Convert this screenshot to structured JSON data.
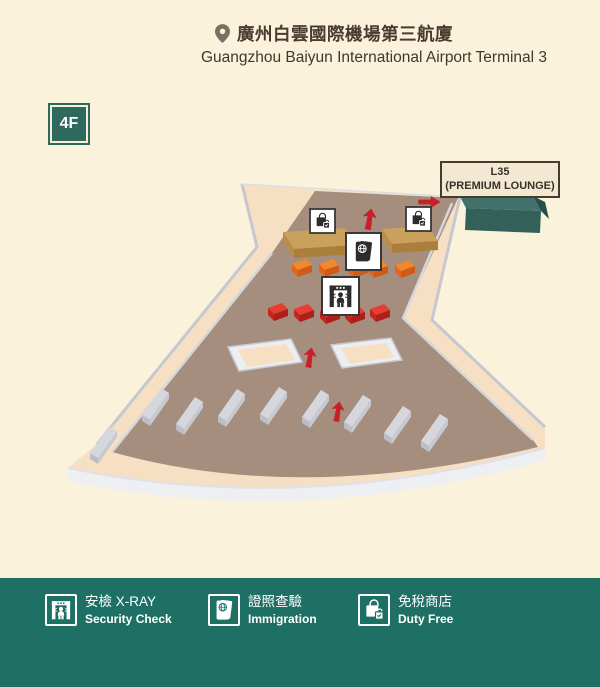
{
  "header": {
    "title_zh": "廣州白雲國際機場第三航廈",
    "title_en": "Guangzhou Baiyun International Airport Terminal 3"
  },
  "floor_badge": {
    "label": "4F"
  },
  "map": {
    "lounge_label": {
      "line1": "L35",
      "line2": "(PREMIUM LOUNGE)"
    },
    "markers": [
      {
        "name": "duty-free-shop",
        "icon": "duty-free-bag-icon"
      },
      {
        "name": "duty-free-shop",
        "icon": "duty-free-bag-icon"
      },
      {
        "name": "immigration",
        "icon": "passport-icon"
      },
      {
        "name": "security-check",
        "icon": "xray-gate-icon"
      }
    ],
    "flow_arrows": [
      "up",
      "up",
      "up",
      "right"
    ],
    "counters": {
      "immigration_counters": 5,
      "security_counters": 5,
      "checkin_counter_slabs": 9,
      "duty_free_counters": 2,
      "stair_wells": 2
    }
  },
  "legend": {
    "items": [
      {
        "icon": "xray-gate-icon",
        "zh": "安檢 X-RAY",
        "en": "Security Check"
      },
      {
        "icon": "passport-icon",
        "zh": "證照查驗",
        "en": "Immigration"
      },
      {
        "icon": "duty-free-bag-icon",
        "zh": "免稅商店",
        "en": "Duty Free"
      }
    ]
  },
  "colors": {
    "background": "#fbf2db",
    "footer_teal": "#1e7064",
    "badge_green": "#2d695c",
    "floor_brown": "#a68e7e",
    "walkway_peach": "#f6dfc3",
    "lounge_teal": "#41726b",
    "counter_tan": "#c9a15c",
    "immigration_orange": "#f0882c",
    "security_red": "#e73e33",
    "arrow_red": "#c8202b",
    "label_cream": "#f3e9d2",
    "title_brown": "#4a3b2f"
  }
}
